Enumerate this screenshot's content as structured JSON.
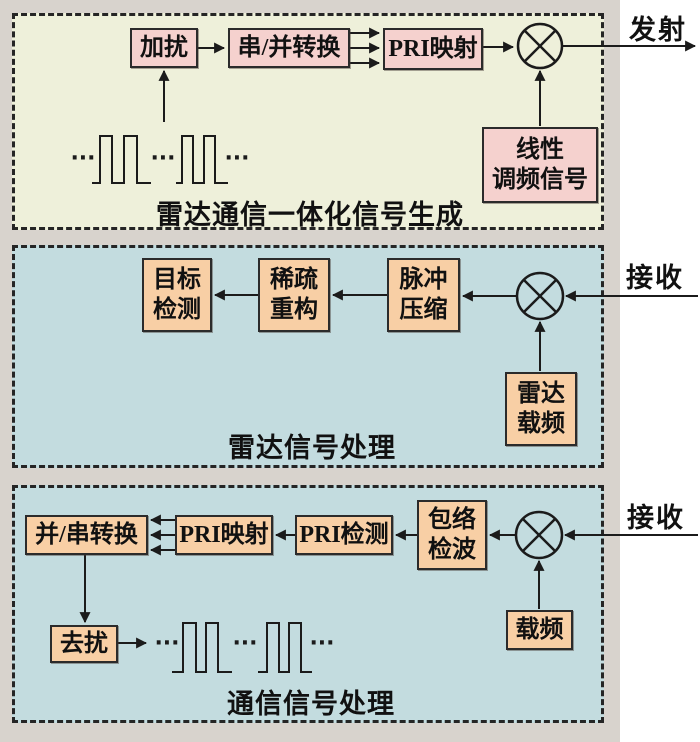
{
  "diagram": {
    "type": "block-diagram",
    "panels": [
      {
        "id": "signal-generation",
        "title": "雷达通信一体化信号生成",
        "io_label": "发射",
        "boxes": {
          "scramble": "加扰",
          "serial_to_parallel": "串/并转换",
          "pri_mapping": "PRI映射",
          "lfm": {
            "line1": "线性",
            "line2": "调频信号"
          }
        },
        "multiplier": "multiply-junction"
      },
      {
        "id": "radar-processing",
        "title": "雷达信号处理",
        "io_label": "接收",
        "boxes": {
          "target_detection": {
            "line1": "目标",
            "line2": "检测"
          },
          "sparse_reconstruction": {
            "line1": "稀疏",
            "line2": "重构"
          },
          "pulse_compression": {
            "line1": "脉冲",
            "line2": "压缩"
          },
          "radar_carrier": {
            "line1": "雷达",
            "line2": "载频"
          }
        },
        "multiplier": "multiply-junction"
      },
      {
        "id": "comm-processing",
        "title": "通信信号处理",
        "io_label": "接收",
        "boxes": {
          "parallel_to_serial": "并/串转换",
          "pri_mapping": "PRI映射",
          "pri_detection": "PRI检测",
          "envelope_detection": {
            "line1": "包络",
            "line2": "检波"
          },
          "carrier": "载频",
          "descramble": "去扰"
        },
        "multiplier": "multiply-junction"
      }
    ],
    "waveform_ellipsis": "···",
    "colors": {
      "figure_margin": "#d8d3cd",
      "panel1_bg": "#eef0da",
      "panel_blue_bg": "#c3dcdf",
      "box_pink": "#f5d1ce",
      "box_peach": "#f8cfa5",
      "line": "#1b1b1b"
    }
  }
}
